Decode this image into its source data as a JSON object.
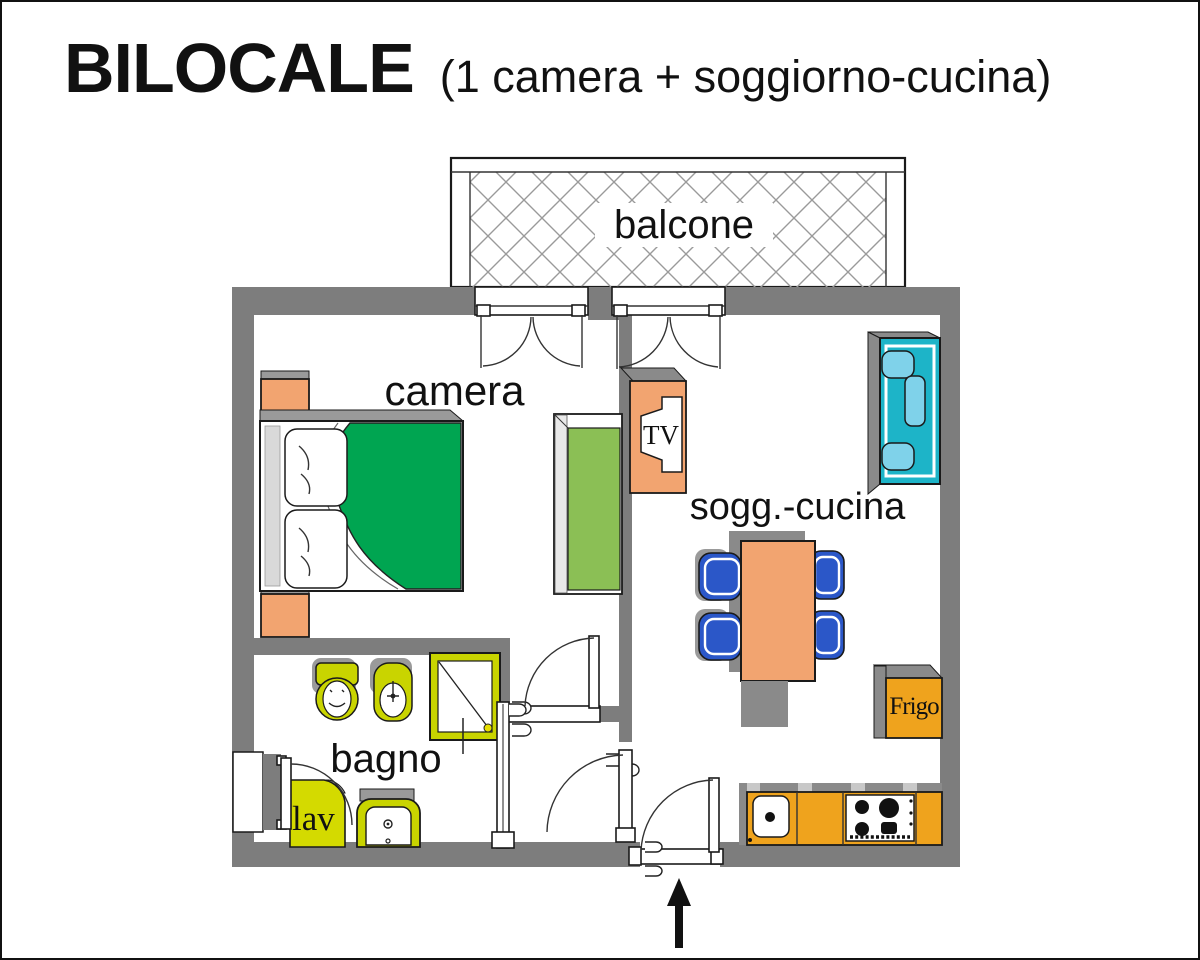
{
  "title": {
    "main": "BILOCALE",
    "subtitle": "(1 camera + soggiorno-cucina)"
  },
  "rooms": {
    "balcony": "balcone",
    "bedroom": "camera",
    "living_kitchen": "sogg.-cucina",
    "bathroom": "bagno"
  },
  "appliances": {
    "tv": "TV",
    "fridge": "Frigo",
    "washer": "lav"
  },
  "colors": {
    "wall": "#7d7d7d",
    "outline": "#1a1a1a",
    "shadow": "#9a9a9a",
    "shadow_dark": "#8a8a8a",
    "bed_green": "#00a551",
    "wardrobe_green": "#8bbf55",
    "furniture_orange": "#f2a470",
    "kitchen_orange": "#efa31d",
    "bath_yellow": "#c9d400",
    "washer_yellow": "#d4da00",
    "sofa_teal": "#1db4c8",
    "sofa_cushion": "#7fd2ea",
    "chair_blue": "#2b57c8",
    "hatch": "#9a9a9a",
    "headboard": "#d9d9d9",
    "tab": "#c8c8c8",
    "shower_dot": "#e6de00"
  }
}
